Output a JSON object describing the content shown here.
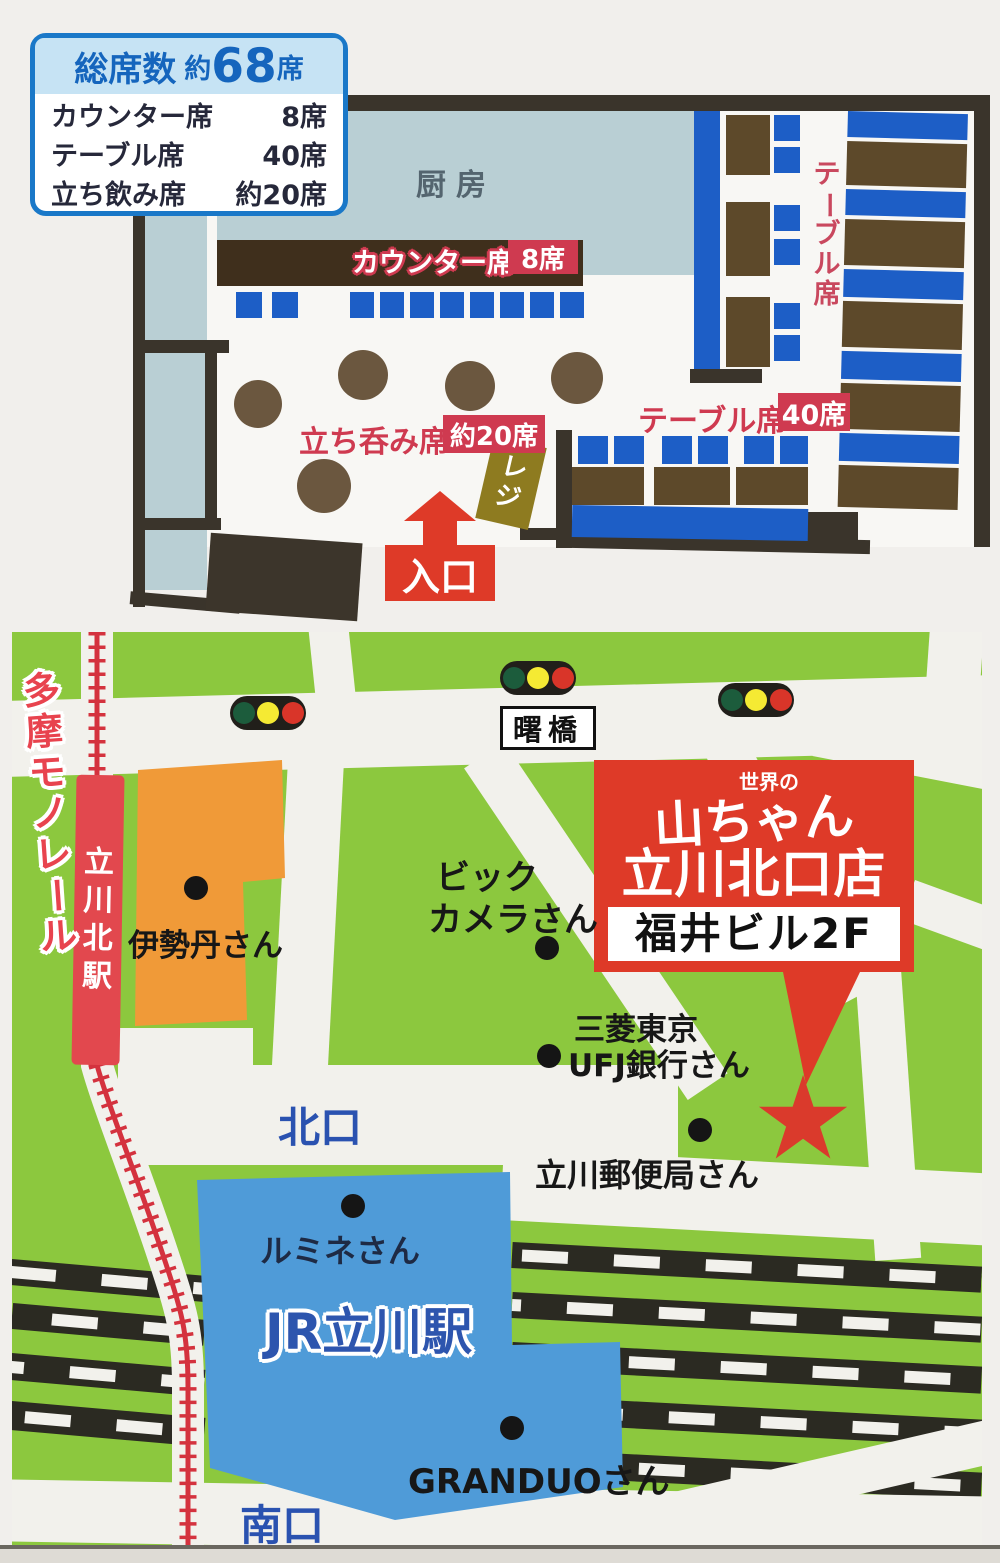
{
  "colors": {
    "paper": "#f1efec",
    "plan-bg": "#f8f7f4",
    "wall": "#3a342b",
    "room": "#b9cfd4",
    "seat": "#1d5ec6",
    "table": "#5d492a",
    "counter": "#3f2f1c",
    "standtable": "#6b573f",
    "label-red": "#cf3a50",
    "bright-red": "#de3a28",
    "gold": "#8e7b20",
    "green": "#8cc83e",
    "road": "#f2f1ec",
    "blue-bldg": "#4f9bd8",
    "orange": "#f09a38",
    "station-red": "#e2484e",
    "text-blue": "#2a52b0",
    "navy": "#1e2a44",
    "mono-red": "#d4323e",
    "info-border": "#1a78c8",
    "info-band": "#c6e3f4",
    "info-blue": "#1565bd",
    "kitchen-text": "#54656f",
    "jr-blue": "#2d55ae",
    "tl-green": "#1c5c3c",
    "tl-yellow": "#f5ea33",
    "tl-red": "#d93529",
    "mono-label": "#e8434e"
  },
  "seat_info": {
    "title_label": "総席数",
    "title_approx": "約",
    "title_count": "68",
    "title_unit": "席",
    "rows": [
      {
        "label": "カウンター席",
        "value": "8席"
      },
      {
        "label": "テーブル席",
        "value": "40席"
      },
      {
        "label": "立ち飲み席",
        "value": "約20席"
      }
    ]
  },
  "floor_plan": {
    "kitchen_label": "厨房",
    "counter_label": "カウンター席",
    "counter_count": "8席",
    "standing_label": "立ち呑み席",
    "standing_count": "約20席",
    "table_label": "テーブル席",
    "table_count": "40席",
    "table_side_label": "テーブル席",
    "register_label": "レジ",
    "entrance_label": "入口"
  },
  "map": {
    "monorail_label": "多摩モノレール",
    "station_north": "立川北駅",
    "bridge_label": "曙橋",
    "isetan": "伊勢丹さん",
    "biccamera_line1": "ビック",
    "biccamera_line2": "カメラさん",
    "sign": {
      "brand_top": "世界の",
      "brand": "山ちゃん",
      "store": "立川北口店",
      "building": "福井ビル2F"
    },
    "bank_line1": "三菱東京",
    "bank_line2": "UFJ銀行さん",
    "post_office": "立川郵便局さん",
    "north_exit": "北口",
    "south_exit": "南口",
    "lumine": "ルミネさん",
    "jr_station": "JR立川駅",
    "granduo": "GRANDUOさん",
    "star_glyph": "★"
  }
}
